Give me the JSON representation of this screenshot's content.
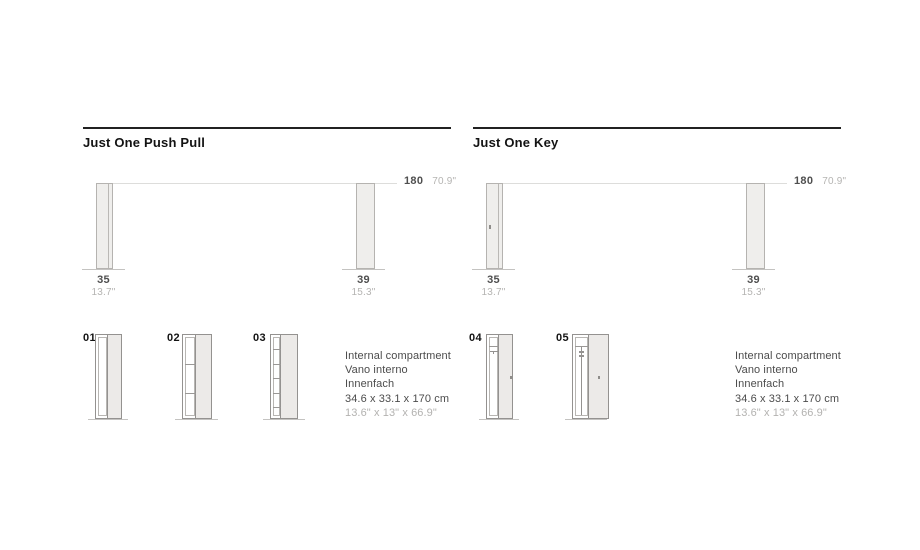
{
  "colors": {
    "rule": "#212121",
    "title_text": "#131313",
    "cabinet_fill": "#efeeec",
    "cabinet_border": "#b5b3b0",
    "small_cabinet_border": "#949290",
    "side_panel_fill": "#eceae8",
    "dimension_line": "#dddddb",
    "floor_line": "#c4c3c1",
    "dark_text": "#4f4f4f",
    "light_text": "#b5b4b2"
  },
  "columns": [
    {
      "title": "Just One Push Pull",
      "height_dim": {
        "cm": "180",
        "inch": "70.9\""
      },
      "cabinet_dims": [
        {
          "cm": "35",
          "inch": "13.7\""
        },
        {
          "cm": "39",
          "inch": "15.3\""
        }
      ],
      "variants": [
        {
          "label": "01",
          "type": "open-compartment"
        },
        {
          "label": "02",
          "type": "three-shelves"
        },
        {
          "label": "03",
          "type": "six-shelves"
        }
      ],
      "spec": {
        "line1": "Internal compartment",
        "line2": "Vano interno",
        "line3": "Innenfach",
        "line4": "34.6 x 33.1 x 170 cm",
        "line5": "13.6\" x 13\" x 66.9\""
      }
    },
    {
      "title": "Just One Key",
      "height_dim": {
        "cm": "180",
        "inch": "70.9\""
      },
      "cabinet_dims": [
        {
          "cm": "35",
          "inch": "13.7\""
        },
        {
          "cm": "39",
          "inch": "15.3\""
        }
      ],
      "variants": [
        {
          "label": "04",
          "type": "shelf-with-hanging-rail"
        },
        {
          "label": "05",
          "type": "shelf-with-vertical-rod"
        }
      ],
      "spec": {
        "line1": "Internal compartment",
        "line2": "Vano interno",
        "line3": "Innenfach",
        "line4": "34.6 x 33.1 x 170 cm",
        "line5": "13.6\" x 13\" x 66.9\""
      }
    }
  ]
}
